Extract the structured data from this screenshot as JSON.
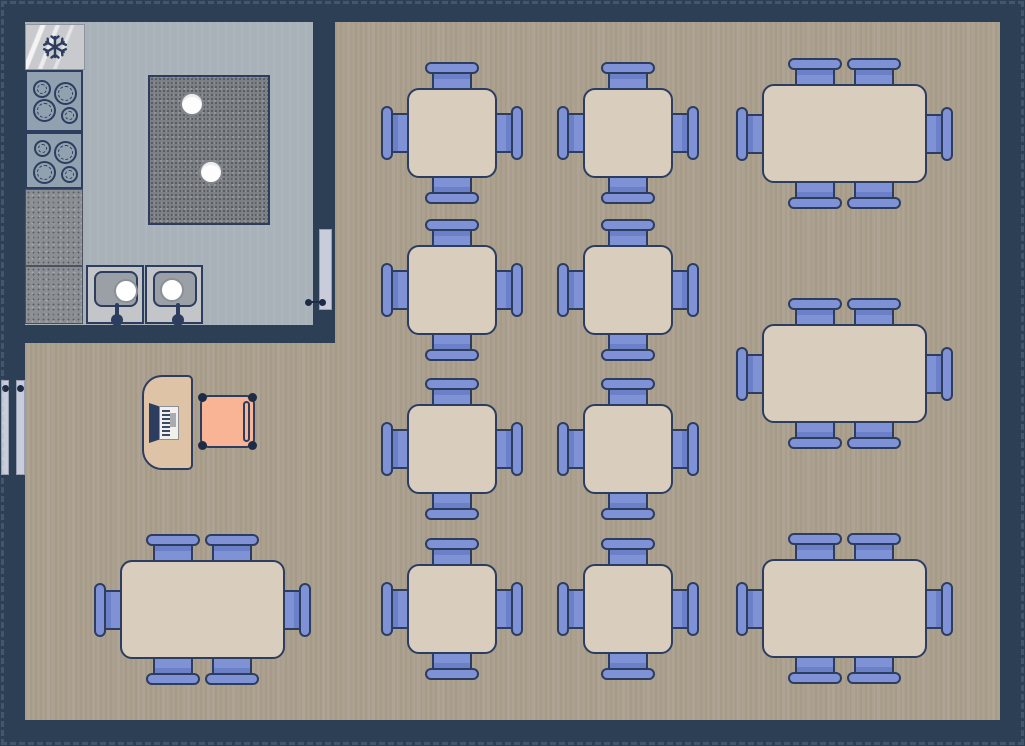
{
  "scene": {
    "title": "restaurant-floor-plan",
    "canvas": {
      "w": 1025,
      "h": 746
    }
  },
  "colors": {
    "wall": "#2d3f55",
    "outline": "#2c3d5f",
    "wood_floor": "#aca08f",
    "kitchen_floor": "#a9b1b9",
    "table_fill": "#d9cdbd",
    "chair_fill": "#8092d6",
    "chair_shade": "#6c80c8",
    "desk_fill": "#dfc3a6",
    "host_chair_fill": "#f8b495",
    "door_fill": "#c9ccda",
    "fridge_fill": "#c9cacd",
    "stove_fill": "#92a1af",
    "counter_fill": "#8b8e92",
    "island_fill": "#7d8085",
    "sink_fill": "#c3c5c8",
    "basin_fill": "#9ba0a6"
  },
  "rooms": {
    "kitchen_floor": {
      "x": 25,
      "y": 22,
      "w": 288,
      "h": 303
    },
    "dining_floor_polygon": [
      [
        335,
        22
      ],
      [
        1000,
        22
      ],
      [
        1000,
        720
      ],
      [
        25,
        720
      ],
      [
        25,
        343
      ],
      [
        335,
        343
      ]
    ]
  },
  "kitchen": {
    "fridge": {
      "x": 25,
      "y": 24,
      "w": 60,
      "h": 46,
      "icon": "snowflake-icon"
    },
    "stoves": [
      {
        "x": 25,
        "y": 70,
        "w": 58,
        "h": 62,
        "burners": [
          {
            "x": 6,
            "y": 8,
            "d": 18
          },
          {
            "x": 27,
            "y": 10,
            "d": 23
          },
          {
            "x": 6,
            "y": 27,
            "d": 23
          },
          {
            "x": 34,
            "y": 35,
            "d": 17
          }
        ]
      },
      {
        "x": 25,
        "y": 132,
        "w": 58,
        "h": 57,
        "burners": [
          {
            "x": 7,
            "y": 6,
            "d": 17
          },
          {
            "x": 27,
            "y": 7,
            "d": 23
          },
          {
            "x": 6,
            "y": 27,
            "d": 23
          },
          {
            "x": 34,
            "y": 32,
            "d": 17
          }
        ]
      }
    ],
    "counters": [
      {
        "x": 25,
        "y": 189,
        "w": 58,
        "h": 77
      },
      {
        "x": 25,
        "y": 266,
        "w": 58,
        "h": 58
      }
    ],
    "island": {
      "x": 148,
      "y": 75,
      "w": 122,
      "h": 150,
      "holes": [
        {
          "cx": 42,
          "cy": 27,
          "r": 12
        },
        {
          "cx": 61,
          "cy": 95,
          "r": 12
        }
      ]
    },
    "sinks": [
      {
        "x": 86,
        "y": 265,
        "w": 58,
        "h": 59,
        "hole_cx": 38,
        "hole_cy": 24,
        "faucet_x": 27
      },
      {
        "x": 145,
        "y": 265,
        "w": 58,
        "h": 59,
        "hole_cx": 25,
        "hole_cy": 23,
        "faucet_x": 29
      }
    ]
  },
  "doors": {
    "kitchen_door": {
      "x": 319,
      "y": 229,
      "w": 13,
      "h": 81,
      "handle": {
        "x1": 308,
        "x2": 322,
        "y": 302
      }
    },
    "entry_door_panels": [
      {
        "x": 1,
        "y": 380,
        "w": 8,
        "h": 95,
        "dot": {
          "cx": 5,
          "cy": 388
        }
      },
      {
        "x": 16,
        "y": 380,
        "w": 9,
        "h": 95,
        "dot": {
          "cx": 20,
          "cy": 388
        }
      }
    ]
  },
  "host_station": {
    "desk": {
      "x": 142,
      "y": 375,
      "w": 51,
      "h": 95
    },
    "register": {
      "x": 149,
      "y": 403,
      "w": 30,
      "h": 40
    },
    "guest_chair": {
      "x": 200,
      "y": 395,
      "w": 55,
      "h": 53
    }
  },
  "tables": {
    "square": {
      "w": 90,
      "h": 90,
      "seats": 4,
      "positions": [
        [
          407,
          88
        ],
        [
          583,
          88
        ],
        [
          407,
          245
        ],
        [
          583,
          245
        ],
        [
          407,
          404
        ],
        [
          583,
          404
        ],
        [
          407,
          564
        ],
        [
          583,
          564
        ]
      ]
    },
    "rect": {
      "w": 165,
      "h": 99,
      "seats": 6,
      "top_bottom_chair_centers": [
        53,
        112
      ],
      "positions": [
        [
          762,
          84
        ],
        [
          762,
          324
        ],
        [
          762,
          559
        ],
        [
          120,
          560
        ]
      ]
    }
  }
}
